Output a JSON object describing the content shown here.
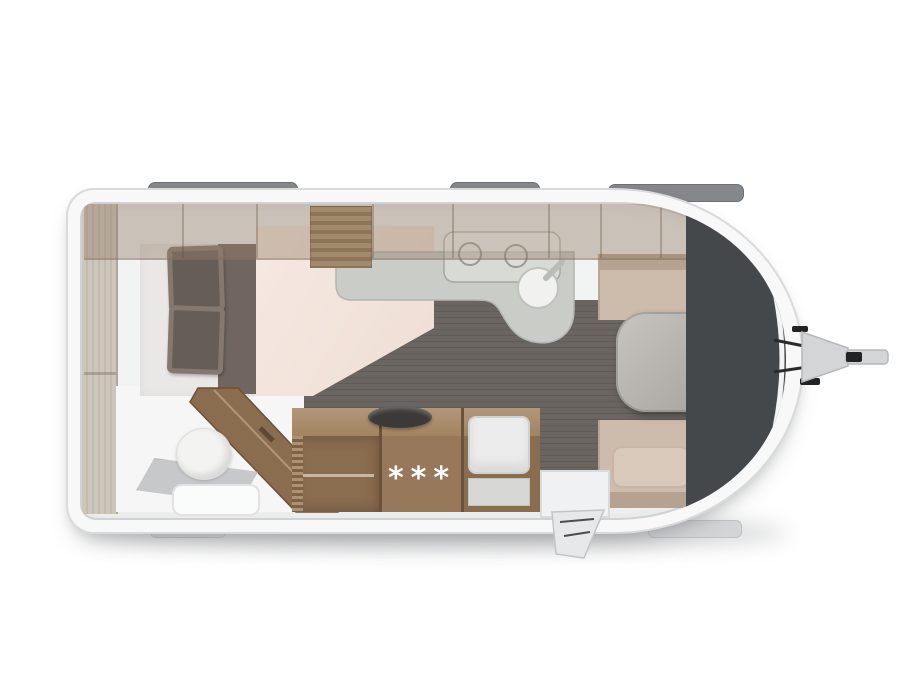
{
  "kitchen": {
    "fridge_rating_stars": "***"
  },
  "colors": {
    "bg": "#ffffff",
    "shell": "#f8f8f9",
    "shell-border": "#d8dadc",
    "wall": "#f2f3f3",
    "skylight": "#85888b",
    "skylight-border": "#6e7174",
    "step": "#d3d5d7",
    "floor": "#6a6561",
    "floor-line": "#5f5b57",
    "wood": "#8a6c4e",
    "wood-mid": "#97785a",
    "wood-top": "#b3977a",
    "wood-dark": "#6b5339",
    "pale-wood": "#cdc6bb",
    "mattress": "#eae8e6",
    "pillow": "#675d57",
    "pillow-edge": "#84786f",
    "runner": "#70665f",
    "duvet": "#f6e9e2",
    "counter": "#c9ccc7",
    "sink": "#f1f1ef",
    "charcoal": "#45484b",
    "bench": "#cdbbac",
    "backrest": "#b6a291",
    "cushion": "#d8c9bb",
    "table": "#a8a4a0",
    "toilet": "#f3f3f2",
    "tray": "#c6c8c9",
    "appliance": "#ececec",
    "hitch": "#d3d5d7",
    "hitch-dark": "#222324"
  },
  "icons": [
    "roof-window",
    "entry-step",
    "tow-hitch",
    "double-bed",
    "pillow",
    "wardrobe-louver",
    "kitchen-sink",
    "cooktop",
    "toilet",
    "shower-tray",
    "bathroom-door",
    "fridge-stars",
    "oven",
    "entry-door",
    "dinette-table",
    "bench-seat",
    "front-window-panel"
  ]
}
